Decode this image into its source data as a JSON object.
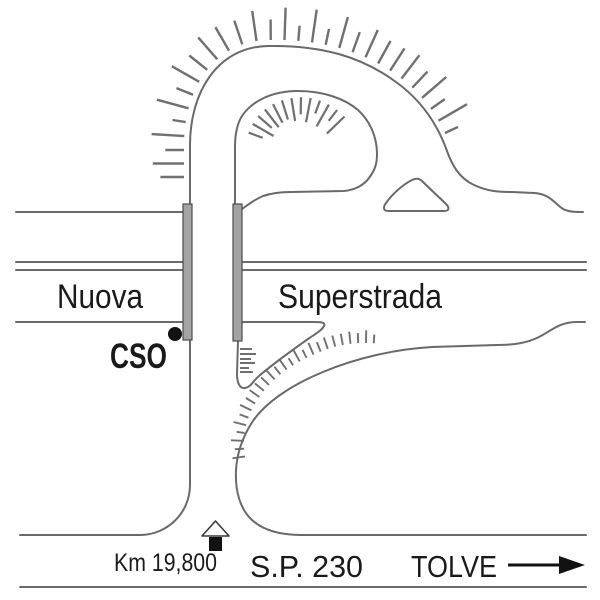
{
  "diagram": {
    "background": "#ffffff",
    "line_color": "#6a6a6a",
    "hatch_color": "#707070",
    "text_color": "#1a1a1a",
    "pier_fill": "#a3a3a3",
    "pier_stroke": "#4d4d4d",
    "ink_color": "#121212",
    "labels": {
      "nuova": "Nuova",
      "superstrada": "Superstrada",
      "cso": "CSO",
      "km_marker": "Km 19,800",
      "road_number": "S.P. 230",
      "destination": "TOLVE"
    },
    "icons": {
      "km_stone": "km-stone-icon",
      "direction_arrow": "direction-arrow-icon",
      "cso_point": "cso-point-dot"
    }
  }
}
